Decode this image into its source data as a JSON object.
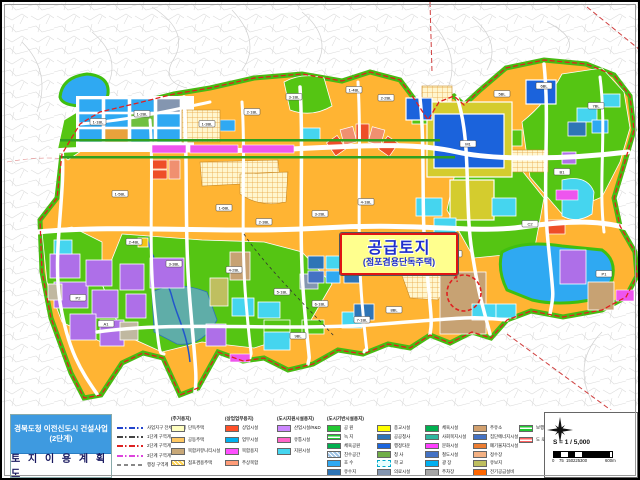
{
  "title_block": {
    "line1": "경북도청 이전신도시 건설사업",
    "line2": "(2단계)",
    "map_title": "토 지 이 용 계 획 도"
  },
  "callout": {
    "title": "공급토지",
    "subtitle": "(점포겸용단독주택)"
  },
  "scale": {
    "ratio_label": "S = 1 / 5,000",
    "bar_ticks": [
      "0",
      "75",
      "150",
      "225",
      "300"
    ],
    "bar_end_label": "600m"
  },
  "legend": {
    "boundary_lines": [
      {
        "label": "사업지구 전체 구역계",
        "color": "#2244cc",
        "style": "dashdot"
      },
      {
        "label": "1단계 구역계",
        "color": "#444444",
        "style": "dashdot"
      },
      {
        "label": "2단계 구역계",
        "color": "#dd2222",
        "style": "dashdot"
      },
      {
        "label": "3단계 구역계",
        "color": "#dd44dd",
        "style": "dashdot"
      },
      {
        "label": "행정 구역계",
        "color": "#888888",
        "style": "dash"
      }
    ],
    "groups": [
      {
        "header": "(주거용지)",
        "items": [
          {
            "label": "단독주택",
            "color": "#ffffc0"
          },
          {
            "label": "공동주택",
            "color": "#ffc862"
          },
          {
            "label": "복합커뮤니티시설",
            "color": "#c8a878"
          },
          {
            "label": "점포겸용주택",
            "color": "#ffd24d",
            "pattern": "hatch"
          }
        ]
      },
      {
        "header": "(상업업무용지)",
        "items": [
          {
            "label": "상업시설",
            "color": "#ff5028"
          },
          {
            "label": "업무시설",
            "color": "#00b0f0"
          },
          {
            "label": "복합용지",
            "color": "#ff50ff"
          },
          {
            "label": "주상복합",
            "color": "#ff9c78"
          }
        ]
      },
      {
        "header": "(도시지원시설용지)",
        "items": [
          {
            "label": "산업시설/R&D",
            "color": "#cc87ff"
          },
          {
            "label": "유통시설",
            "color": "#ff64c8"
          },
          {
            "label": "지원시설",
            "color": "#45d5ef"
          }
        ]
      },
      {
        "header": "(도시기반시설용지)",
        "items": [
          {
            "label": "공 원",
            "color": "#22c832"
          },
          {
            "label": "녹 지",
            "color": "#22c832",
            "pattern": "stripes"
          },
          {
            "label": "체육공원",
            "color": "#00b050"
          },
          {
            "label": "친수공간",
            "color": "#9dc3e6",
            "pattern": "hatch"
          },
          {
            "label": "호 수",
            "color": "#2fa9f2"
          },
          {
            "label": "유수지",
            "color": "#2e75b6"
          }
        ]
      },
      {
        "header": "",
        "items": [
          {
            "label": "종교시설",
            "color": "#ffff00"
          },
          {
            "label": "공공청사",
            "color": "#2e75b6"
          },
          {
            "label": "행정타운",
            "color": "#1b66de"
          },
          {
            "label": "청 사",
            "color": "#70ad47"
          },
          {
            "label": "학 교",
            "color": "#ccffff",
            "pattern": "dashedborder"
          },
          {
            "label": "의료시설",
            "color": "#8496b0"
          }
        ]
      },
      {
        "header": "",
        "items": [
          {
            "label": "체육시설",
            "color": "#00b050"
          },
          {
            "label": "사회복지시설",
            "color": "#2eb6a0"
          },
          {
            "label": "문화시설",
            "color": "#ff40ff"
          },
          {
            "label": "철도시설",
            "color": "#4472c4"
          },
          {
            "label": "광 장",
            "color": "#00b0f0"
          },
          {
            "label": "주차장",
            "color": "#a6a6a6"
          }
        ]
      },
      {
        "header": "",
        "items": [
          {
            "label": "주유소",
            "color": "#d2a06e"
          },
          {
            "label": "집단에너지시설",
            "color": "#4472c4"
          },
          {
            "label": "폐기물처리시설",
            "color": "#ed7d31"
          },
          {
            "label": "정수장",
            "color": "#f4b183"
          },
          {
            "label": "유보지",
            "color": "#bfbf60"
          },
          {
            "label": "전기공급설비",
            "color": "#ff6600"
          }
        ]
      },
      {
        "header": "",
        "items": [
          {
            "label": "보행녹도",
            "color": "#22c832",
            "pattern": "hstripes"
          },
          {
            "label": "도 로",
            "color": "#ff6060",
            "pattern": "hstripes"
          }
        ]
      }
    ]
  },
  "map_labels": [
    {
      "t": "1-1BL",
      "x": 96,
      "y": 120
    },
    {
      "t": "1-2BL",
      "x": 140,
      "y": 112
    },
    {
      "t": "1-3BL",
      "x": 205,
      "y": 122
    },
    {
      "t": "2-1BL",
      "x": 250,
      "y": 110
    },
    {
      "t": "3-1BL",
      "x": 292,
      "y": 95
    },
    {
      "t": "1-4BL",
      "x": 352,
      "y": 88
    },
    {
      "t": "2-2BL",
      "x": 384,
      "y": 96
    },
    {
      "t": "5BL",
      "x": 500,
      "y": 92
    },
    {
      "t": "6BL",
      "x": 542,
      "y": 84
    },
    {
      "t": "7BL",
      "x": 594,
      "y": 104
    },
    {
      "t": "M1",
      "x": 466,
      "y": 142
    },
    {
      "t": "1-5BL",
      "x": 118,
      "y": 192
    },
    {
      "t": "1-6BL",
      "x": 222,
      "y": 206
    },
    {
      "t": "2-3BL",
      "x": 262,
      "y": 220
    },
    {
      "t": "3-2BL",
      "x": 318,
      "y": 212
    },
    {
      "t": "4-1BL",
      "x": 364,
      "y": 200
    },
    {
      "t": "2-4BL",
      "x": 132,
      "y": 240
    },
    {
      "t": "3-3BL",
      "x": 172,
      "y": 262
    },
    {
      "t": "4-2BL",
      "x": 232,
      "y": 268
    },
    {
      "t": "5-1BL",
      "x": 280,
      "y": 290
    },
    {
      "t": "6-1BL",
      "x": 318,
      "y": 302
    },
    {
      "t": "7-1BL",
      "x": 360,
      "y": 318
    },
    {
      "t": "8BL",
      "x": 392,
      "y": 308
    },
    {
      "t": "9BL",
      "x": 296,
      "y": 334
    },
    {
      "t": "C1",
      "x": 452,
      "y": 252
    },
    {
      "t": "C2",
      "x": 528,
      "y": 222
    },
    {
      "t": "P1",
      "x": 602,
      "y": 272
    },
    {
      "t": "P2",
      "x": 76,
      "y": 296
    },
    {
      "t": "A1",
      "x": 104,
      "y": 322
    },
    {
      "t": "B1",
      "x": 560,
      "y": 170
    }
  ],
  "colors": {
    "residential_base": "#ffb433",
    "park_green": "#55c513",
    "water_blue": "#2fa9f2",
    "office_blue": "#1b63dc",
    "commercial_magenta": "#ee55ee",
    "boundary_red": "#e02020"
  }
}
